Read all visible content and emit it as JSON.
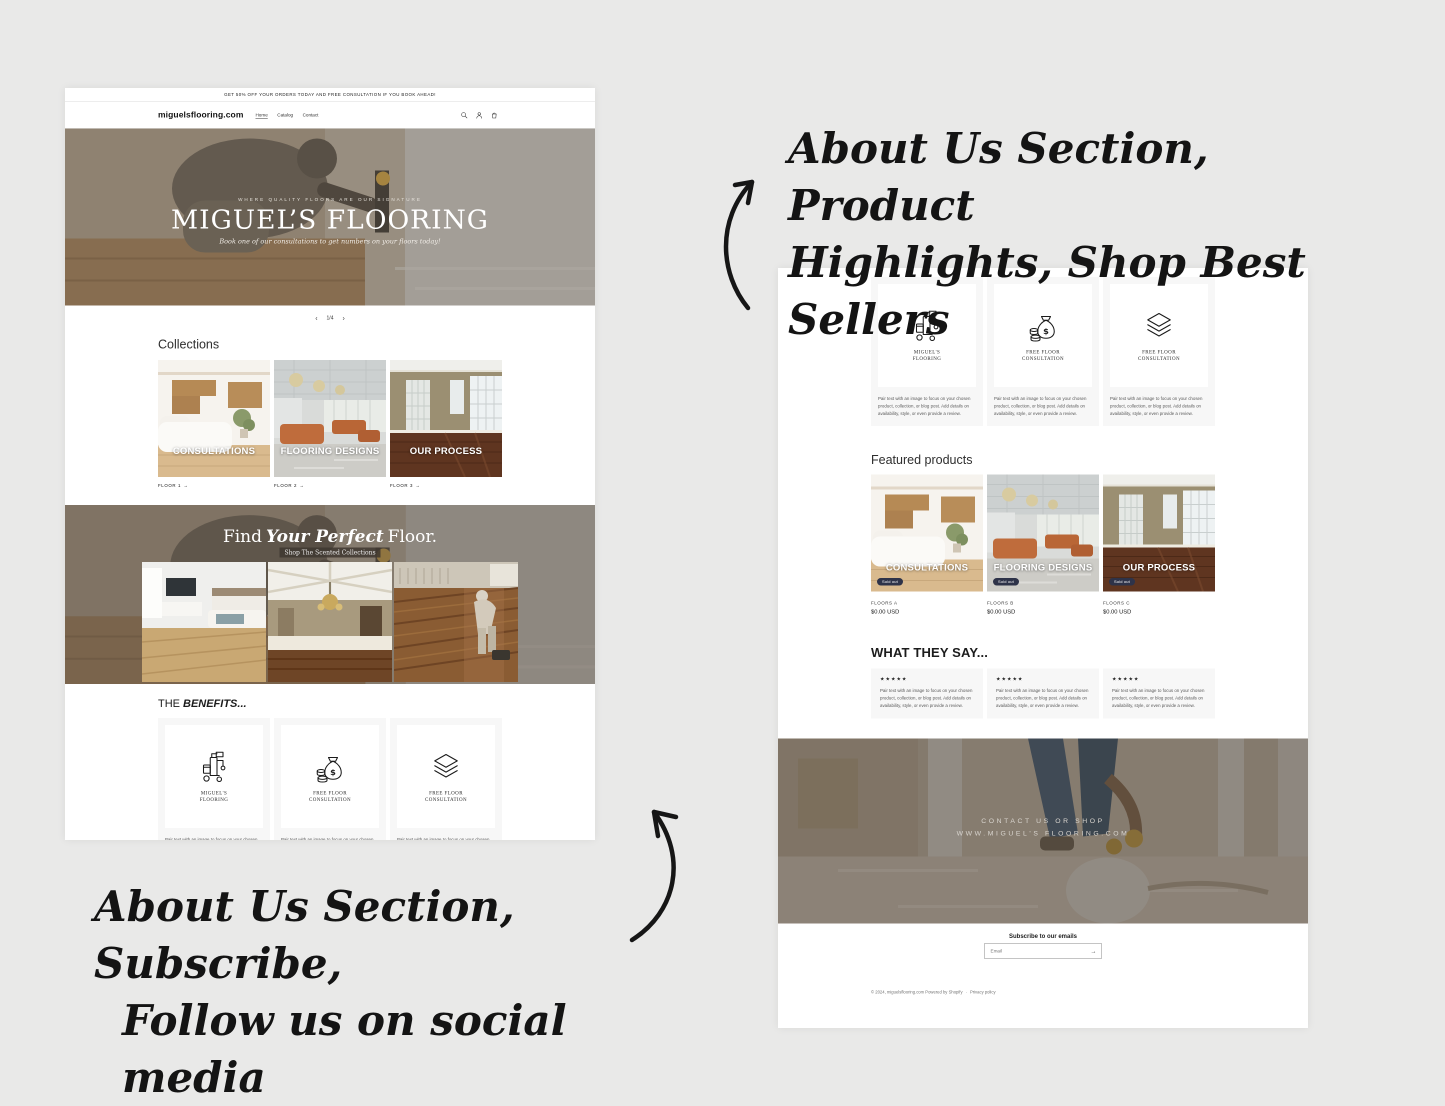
{
  "colors": {
    "canvas_bg": "#e9e9e8",
    "badge_bg": "#2e3349",
    "card_bg": "#f7f7f7",
    "text_dark": "#121212",
    "muted_text": "#595959"
  },
  "annotations": {
    "top_line1": "About Us Section, Product",
    "top_line2": "Highlights, Shop Best Sellers",
    "bottom_line1": "About Us Section, Subscribe,",
    "bottom_line2": "Follow us on social media"
  },
  "shared": {
    "pair_text": "Pair text with an image to focus on your chosen product, collection, or blog post. Add details on availability, style, or even provide a review.",
    "stars": "★★★★★",
    "arrow": "→",
    "sold_out": "Sold out",
    "benefits_heading_pre": "THE",
    "benefits_heading_em": "BENEFITS...",
    "benefit_cards": [
      {
        "icon": "cleaning-machine-icon",
        "label_line1": "MIGUEL'S",
        "label_line2": "FLOORING"
      },
      {
        "icon": "money-bag-icon",
        "label_line1": "FREE FLOOR",
        "label_line2": "CONSULTATION"
      },
      {
        "icon": "floor-layers-icon",
        "label_line1": "FREE FLOOR",
        "label_line2": "CONSULTATION"
      }
    ]
  },
  "left_page": {
    "announcement": "GET 50% OFF YOUR ORDERS TODAY AND FREE CONSULTATION IF YOU BOOK AHEAD!",
    "header": {
      "logo": "miguelsflooring.com",
      "nav": [
        {
          "label": "Home"
        },
        {
          "label": "Catalog"
        },
        {
          "label": "Contact"
        }
      ],
      "icons": [
        "search-icon",
        "account-icon",
        "cart-icon"
      ]
    },
    "hero": {
      "eyebrow": "WHERE QUALITY FLOORS ARE OUR SIGNATURE",
      "title": "MIGUEL’S FLOORING",
      "subtitle": "Book one of our consultations to get numbers on your floors today!"
    },
    "pagination": {
      "prev": "‹",
      "current": "1/4",
      "next": "›"
    },
    "collections": {
      "heading": "Collections",
      "items": [
        {
          "caption": "CONSULTATIONS",
          "link": "FLOOR 1"
        },
        {
          "caption": "FLOORING DESIGNS",
          "link": "FLOOR 2"
        },
        {
          "caption": "OUR PROCESS",
          "link": "FLOOR 3"
        }
      ]
    },
    "banner": {
      "title_pre": "Find",
      "title_em": "Your Perfect",
      "title_post": "Floor.",
      "subtitle": "Shop The Scented Collections"
    }
  },
  "right_page": {
    "featured": {
      "heading": "Featured products",
      "products": [
        {
          "caption": "CONSULTATIONS",
          "name": "FLOORS A",
          "price": "$0.00 USD"
        },
        {
          "caption": "FLOORING DESIGNS",
          "name": "FLOORS B",
          "price": "$0.00 USD"
        },
        {
          "caption": "OUR PROCESS",
          "name": "FLOORS C",
          "price": "$0.00 USD"
        }
      ]
    },
    "testimonials": {
      "heading": "WHAT THEY SAY..."
    },
    "footer_banner": {
      "line1": "CONTACT US OR SHOP",
      "line2": "WWW.MIGUEL'S FLOORING.COM"
    },
    "subscribe": {
      "heading": "Subscribe to our emails",
      "placeholder": "Email"
    },
    "footer": {
      "copyright": "© 2024, miguelsflooring.com Powered by Shopify",
      "divider": "·",
      "privacy": "Privacy policy"
    }
  }
}
